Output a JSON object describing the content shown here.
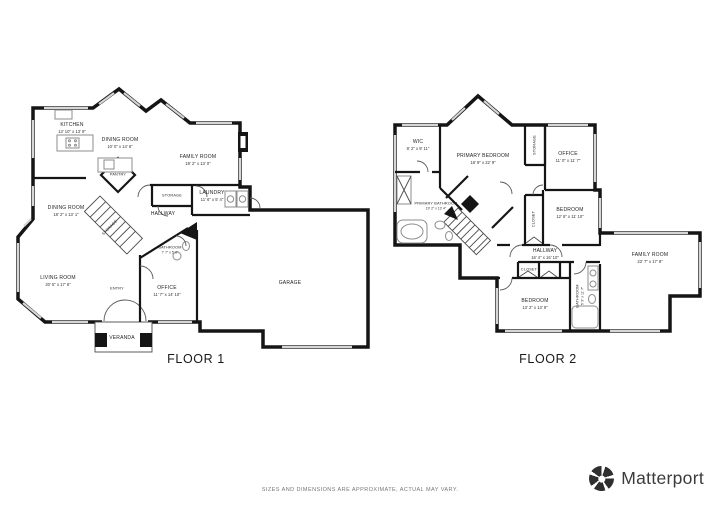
{
  "floor1": {
    "title": "FLOOR 1",
    "rooms": [
      {
        "name": "KITCHEN",
        "dims": "13' 10\" x 13' 9\""
      },
      {
        "name": "DINING ROOM",
        "dims": "10' 0\" x 14' 6\""
      },
      {
        "name": "FAMILY ROOM",
        "dims": "19' 2\" x 13' 0\""
      },
      {
        "name": "PANTRY",
        "dims": ""
      },
      {
        "name": "STORAGE",
        "dims": ""
      },
      {
        "name": "LAUNDRY",
        "dims": "11' 6\" x 5' 4\""
      },
      {
        "name": "HALLWAY",
        "dims": ""
      },
      {
        "name": "DINING ROOM",
        "dims": "18' 2\" x 13' 1\""
      },
      {
        "name": "STORAGE",
        "dims": ""
      },
      {
        "name": "LIVING ROOM",
        "dims": "20' 5\" x 17' 6\""
      },
      {
        "name": "ENTRY",
        "dims": ""
      },
      {
        "name": "BATHROOM",
        "dims": "7' 7\" x 5' 0\""
      },
      {
        "name": "OFFICE",
        "dims": "11' 7\" x 14' 10\""
      },
      {
        "name": "VERANDA",
        "dims": ""
      },
      {
        "name": "GARAGE",
        "dims": ""
      }
    ]
  },
  "floor2": {
    "title": "FLOOR 2",
    "rooms": [
      {
        "name": "WIC",
        "dims": "8' 2\" x 9' 11\""
      },
      {
        "name": "PRIMARY BEDROOM",
        "dims": "18' 9\" x 22' 9\""
      },
      {
        "name": "STORAGE",
        "dims": ""
      },
      {
        "name": "OFFICE",
        "dims": "11' 0\" x 11' 7\""
      },
      {
        "name": "PRIMARY BATHROOM",
        "dims": "19' 2\" x 13' 4\""
      },
      {
        "name": "CLOSET",
        "dims": ""
      },
      {
        "name": "BEDROOM",
        "dims": "12' 6\" x 11' 10\""
      },
      {
        "name": "HALLWAY",
        "dims": "16' 4\" x 16' 10\""
      },
      {
        "name": "CLOSET",
        "dims": ""
      },
      {
        "name": "BEDROOM",
        "dims": "13' 2\" x 13' 9\""
      },
      {
        "name": "BATHROOM",
        "dims": "5' 3\" x 11' 7\""
      },
      {
        "name": "FAMILY ROOM",
        "dims": "23' 7\" x 17' 8\""
      }
    ]
  },
  "footer": {
    "disclaimer": "SIZES AND DIMENSIONS ARE APPROXIMATE, ACTUAL MAY VARY."
  },
  "brand": {
    "name": "Matterport",
    "icon": "matterport-pinwheel-icon"
  }
}
